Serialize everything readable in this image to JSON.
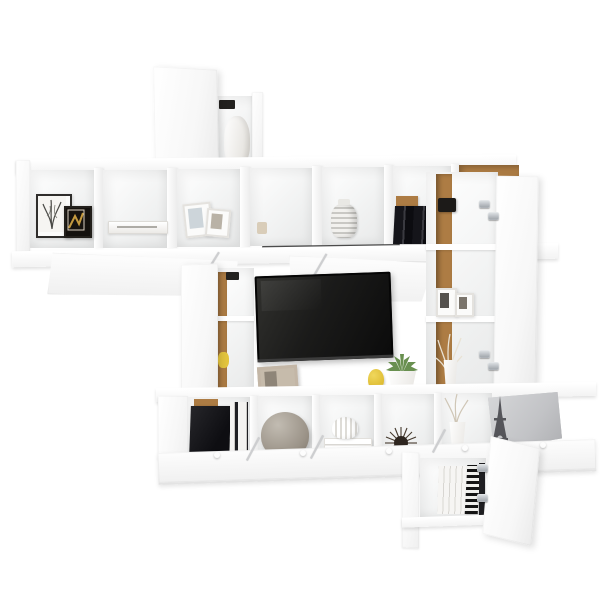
{
  "meta": {
    "type": "product-photo",
    "subject": "White wall-mounted TV entertainment shelving combination with open doors and decor items",
    "background": "#ffffff"
  },
  "palette": {
    "furniture_white": "#fbfbfb",
    "edge_gray": "#e7e7e7",
    "wood": "#ad7c44",
    "wood_dark": "#8a6130",
    "tv_dark": "#121212",
    "accent_yellow": "#e3c43e",
    "succulent_green": "#699050",
    "vase_gray": "#a09a8f",
    "decor_black": "#191919",
    "chrome": "#b9bdc2",
    "door_gray": "#c6c7c9",
    "dried_tan": "#c9b99b",
    "frame_beige": "#c3b6a6"
  },
  "items": {
    "unit": "White wall-mounted TV shelving unit",
    "top_cabinet": "Top wall cabinet with open door",
    "top_vase": "White vase inside top cabinet",
    "upper_shelf": "Upper open cube shelf row",
    "frame_botanical": "Framed botanical print",
    "frame_dark": "Framed dark artwork",
    "flat_book": "White book lying flat",
    "leaning_frames": "Leaning white photo frames",
    "ceramic_jar": "Patterned ceramic jar",
    "dark_books": "Dark books with wood bookend",
    "wood_cube": "Cube with wood back panel and dried twigs",
    "tv": "Flat-screen TV with dark screen",
    "photo_frame_beige": "Beige photo frame",
    "yellow_vase": "Small yellow vase",
    "succulent": "Potted green succulent",
    "left_column": "Left column cabinet with open door",
    "right_cabinet": "Tall right cabinet with open door",
    "hinge": "Chrome hinge",
    "small_frames": "Small photo frames on cabinet shelf",
    "dried_grass": "White vase with dried grass",
    "bottom_shelf": "Bottom shelf row with drop-down doors open",
    "media_boxes": "Black media boxes and book spines",
    "gray_vase": "Round gray ceramic vase",
    "white_vase_books": "White ridged vase on stacked books",
    "urchin_decor": "Dark spiky urchin ornament",
    "twig_vase": "White vase with dried twigs",
    "eiffel": "Eiffel Tower figurine",
    "open_flap": "Open drop-down door panel",
    "gray_door": "Open gray cabinet door",
    "bottom_cabinet": "Low cabinet with books and open door",
    "striped_book": "Black and white striped book"
  }
}
